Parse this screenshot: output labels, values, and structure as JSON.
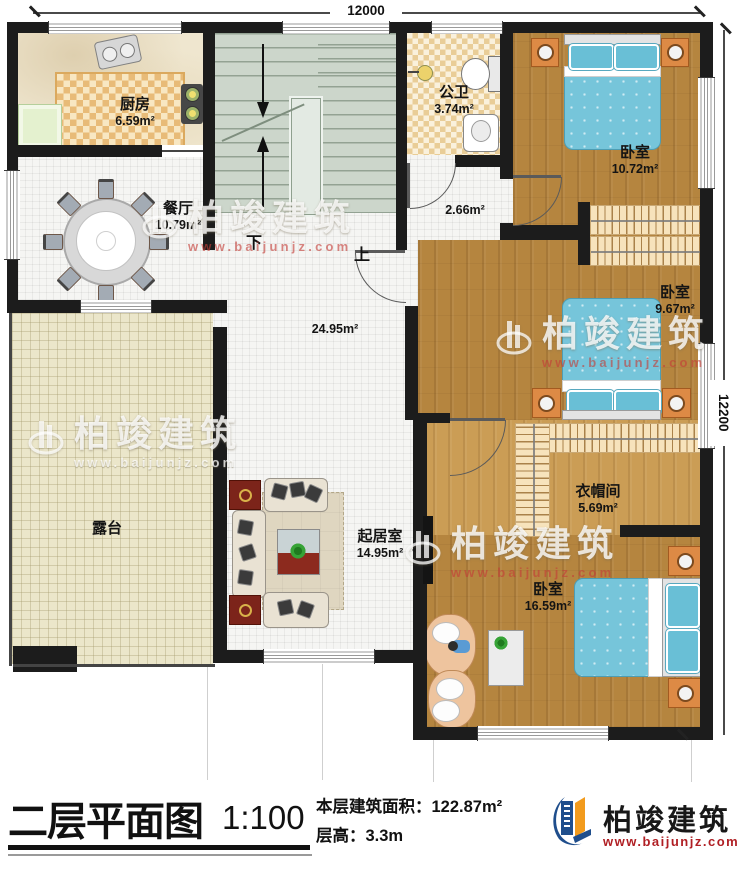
{
  "dimensions": {
    "top": "12000",
    "right": "12200"
  },
  "stairs": {
    "down": "下",
    "up": "上"
  },
  "rooms": {
    "kitchen": {
      "name": "厨房",
      "area": "6.59m²"
    },
    "bath": {
      "name": "公卫",
      "area": "3.74m²"
    },
    "corridor": {
      "area": "2.66m²"
    },
    "bedroom_top": {
      "name": "卧室",
      "area": "10.72m²"
    },
    "bedroom_mid": {
      "name": "卧室",
      "area": "9.67m²"
    },
    "closet": {
      "name": "衣帽间",
      "area": "5.69m²"
    },
    "bedroom_master": {
      "name": "卧室",
      "area": "16.59m²"
    },
    "dining": {
      "name": "餐厅",
      "area": "10.79m²"
    },
    "hall": {
      "area": "24.95m²"
    },
    "terrace": {
      "name": "露台"
    },
    "living": {
      "name": "起居室",
      "area": "14.95m²"
    }
  },
  "watermark": {
    "brand": "柏竣建筑",
    "url": "www.baijunjz.com"
  },
  "titlebar": {
    "title": "二层平面图",
    "scale": "1:100",
    "area_label": "本层建筑面积：",
    "area_value": "122.87m²",
    "height_label": "层高：",
    "height_value": "3.3m"
  },
  "logo": {
    "brand": "柏竣建筑",
    "url": "www.baijunjz.com"
  },
  "colors": {
    "wall": "#1c1c1c",
    "wood": "#b5853f",
    "bed_blue": "#76c5da",
    "logo_blue": "#1f4e8c",
    "logo_orange": "#f29b1d",
    "logo_red": "#b01f24"
  }
}
